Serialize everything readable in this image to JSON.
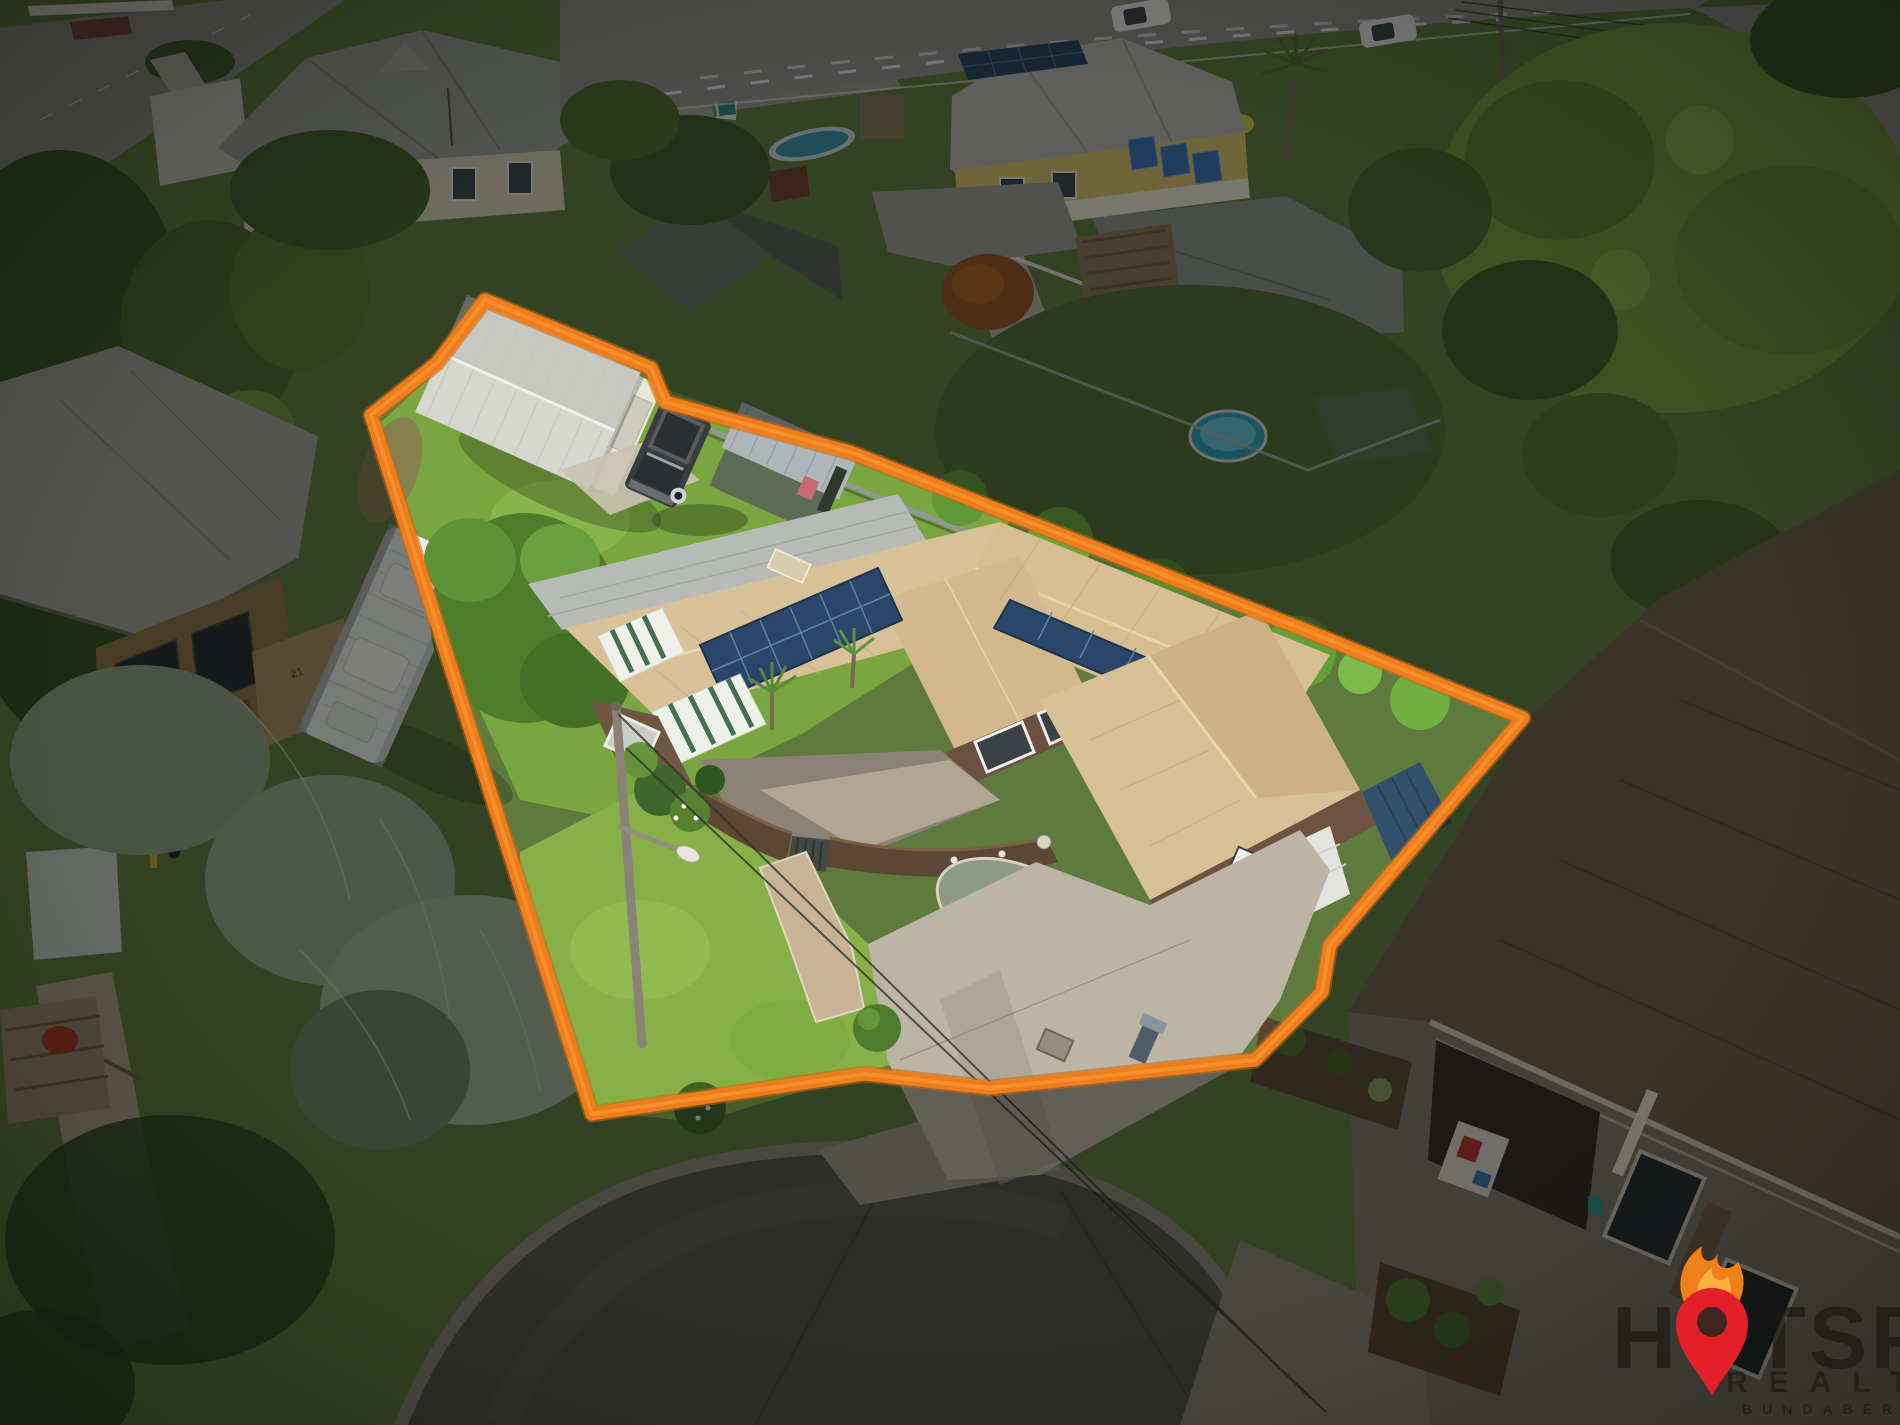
{
  "image": {
    "kind": "aerial real estate photograph",
    "subject": "suburban house lot highlighted with boundary outline",
    "lighting": "daytime"
  },
  "watermark": {
    "brand": "HOTSPOT",
    "line1_left": "H",
    "line1_right": "TSPOT",
    "line2": "REALTY",
    "line3": "BUNDABERG",
    "text_color": "#181512",
    "pin_color": "#E32029",
    "flame_outer_color": "#F08019",
    "flame_inner_color": "#FCB03E"
  },
  "property": {
    "house_number": "19",
    "boundary_color": "#EF7D1C",
    "features": "shed, caravan, trailer 4wd, garden shed, solar panels, double garage, basketball hoop, cul-de-sac frontage"
  },
  "neighbors": {
    "left_house_number": "21"
  },
  "palette": {
    "lawn_bright": "#86B148",
    "lawn_back": "#7AA63F",
    "roof_tan": "#D9C197",
    "roof_gray": "#9B9C98",
    "asphalt": "#52504B",
    "driveway": "#BCB4A4",
    "dim_overlay": "#0A0C0A"
  }
}
